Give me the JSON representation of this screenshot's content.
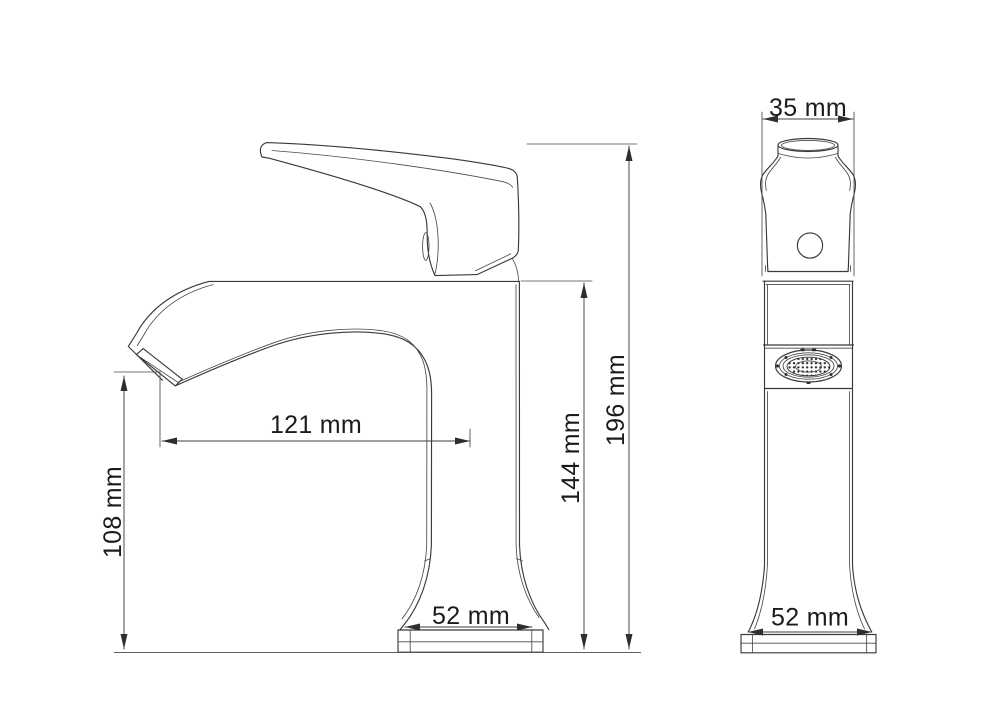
{
  "figure": {
    "unit": "mm",
    "colors": {
      "background": "#ffffff",
      "line": "#3a3a3a",
      "text": "#1b1b1b"
    }
  },
  "views": {
    "side": {
      "dims": {
        "spout_reach": {
          "label": "121 mm",
          "value": 121
        },
        "outlet_height": {
          "label": "108 mm",
          "value": 108
        },
        "deck_height": {
          "label": "144 mm",
          "value": 144
        },
        "overall_height": {
          "label": "196 mm",
          "value": 196
        },
        "base_width": {
          "label": "52 mm",
          "value": 52
        }
      }
    },
    "front": {
      "dims": {
        "handle_width": {
          "label": "35 mm",
          "value": 35
        },
        "base_width": {
          "label": "52 mm",
          "value": 52
        }
      }
    }
  }
}
